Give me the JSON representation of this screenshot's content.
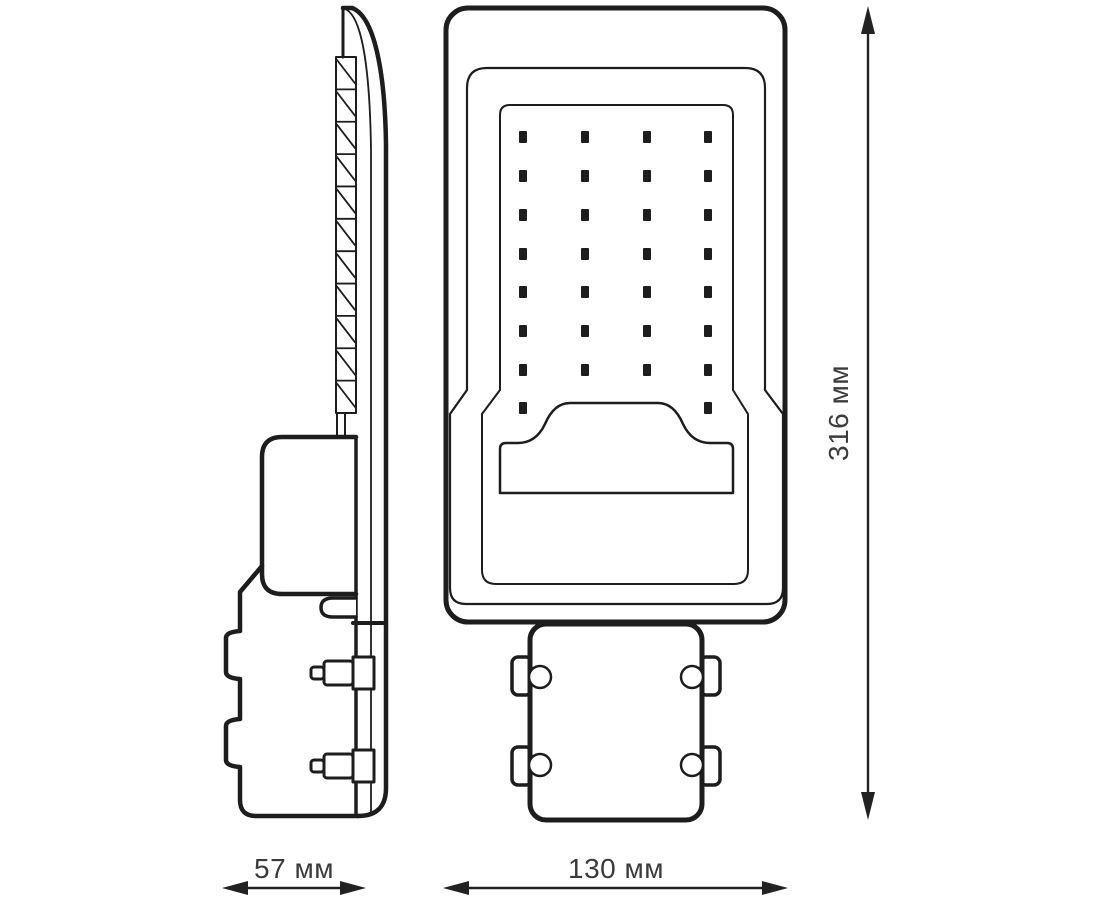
{
  "drawing": {
    "subject": "led-street-light-dimension-drawing",
    "views": [
      "side-view",
      "front-view"
    ],
    "background_color": "#ffffff",
    "line_color": "#1d1d1d",
    "text_color": "#3b3b3b"
  },
  "dimensions": {
    "side_width_label": "57 мм",
    "front_width_label": "130 мм",
    "height_label": "316 мм"
  },
  "led_grid": {
    "columns": 4,
    "full_rows": 7,
    "columns_x": [
      523,
      585,
      647,
      708
    ],
    "rows_y": [
      137,
      176,
      215,
      254,
      292,
      331,
      370
    ],
    "partial_row_y": 408,
    "partial_columns_x": [
      523,
      708
    ],
    "dot_w": 8,
    "dot_h": 12,
    "dot_color": "#1d1d1d"
  },
  "heatsink": {
    "fin_count": 11,
    "left": 336,
    "right": 356,
    "top": 57,
    "bottom": 413
  },
  "mounting": {
    "front_hole_count": 4,
    "side_bolt_count": 2
  }
}
